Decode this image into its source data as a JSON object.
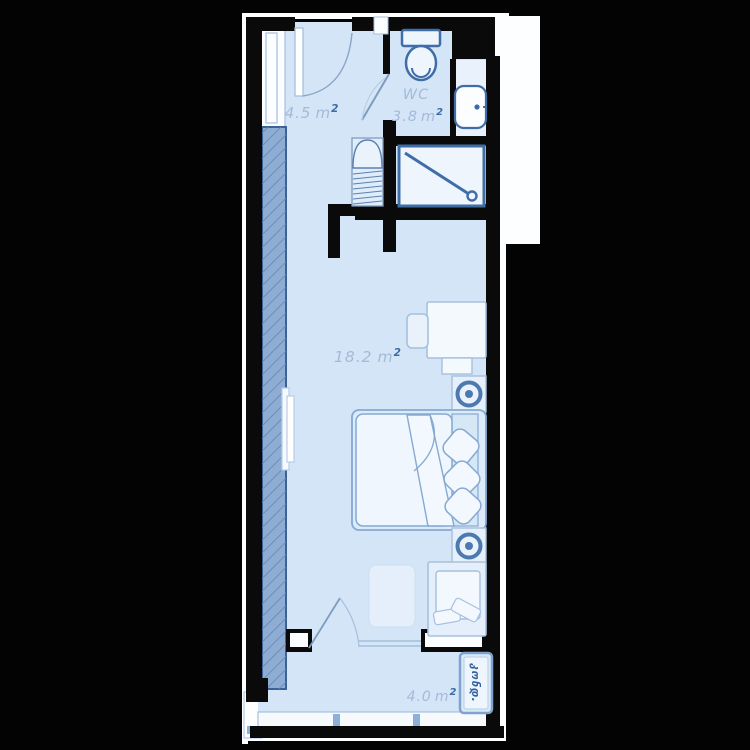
{
  "plan": {
    "type": "studio-apartment-floor-plan",
    "rooms": {
      "hall": {
        "area": "4.5",
        "unit": "m",
        "sup": "2"
      },
      "wc": {
        "name": "WC",
        "area": "3.8",
        "unit": "m",
        "sup": "2"
      },
      "living": {
        "area": "18.2",
        "unit": "m",
        "sup": "2"
      },
      "balcony": {
        "area": "4.0",
        "unit": "m",
        "sup": "2"
      },
      "ac_unit": {
        "label": "კონდ."
      }
    },
    "colors": {
      "background": "#030303",
      "wall": "#0a0a0a",
      "outline_white": "#fdfeff",
      "floor": "#d3e5f6",
      "floor_pale": "#e9f2fc",
      "hatch_wall_fill": "#8fadd3",
      "hatch_wall_line": "#6288ba",
      "hatch_wall_border": "#3a6296",
      "fixture_stroke": "#3f6da7",
      "furniture_stroke": "#a6c0de",
      "bed_stroke": "#86a9d2",
      "label_text": "#a4bad8",
      "label_sup": "#3c6ca6",
      "lamp": "#4c79b0"
    }
  }
}
